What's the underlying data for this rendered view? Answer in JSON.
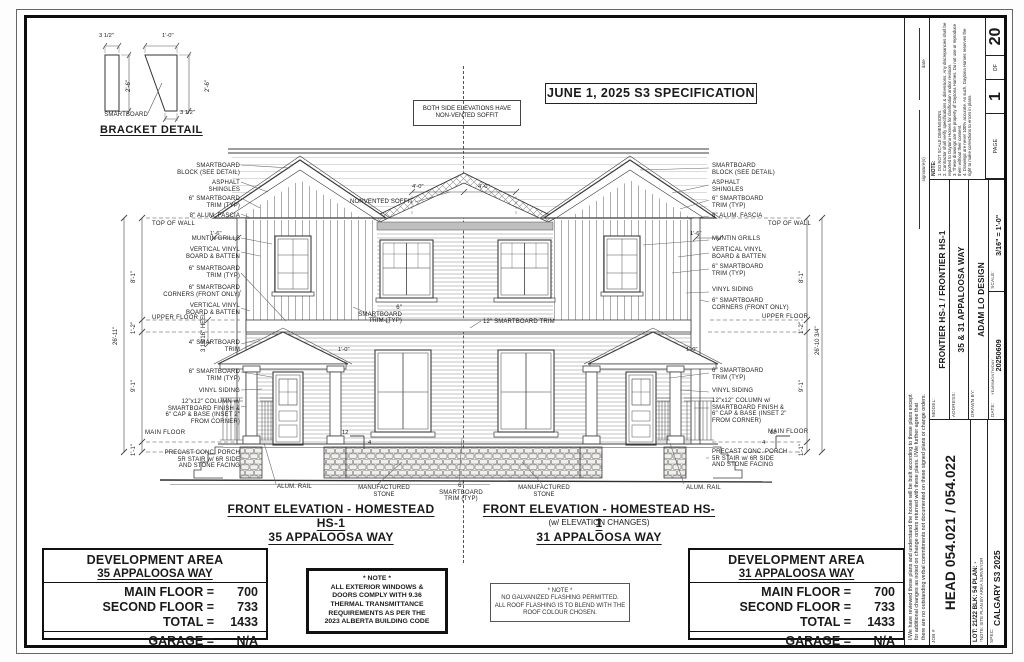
{
  "bracket": {
    "title": "BRACKET DETAIL",
    "material_label": "SMARTBOARD",
    "dim_w1": "3 1/2\"",
    "dim_w2": "1'-0\"",
    "dim_h1": "2'-6\"",
    "dim_h2": "2'-6\"",
    "dim_b2": "3 1/2\""
  },
  "banners": {
    "spec": "JUNE 1, 2025 S3 SPECIFICATION",
    "soffit": "BOTH SIDE ELEVATIONS HAVE\nNON-VENTED SOFFIT"
  },
  "ann": {
    "left": [
      "SMARTBOARD\nBLOCK (SEE DETAIL)",
      "ASPHALT\nSHINGLES",
      "6\" SMARTBOARD\nTRIM (TYP)",
      "8\" ALUM. FASCIA",
      "TOP OF WALL",
      "MUNTIN GRILLS",
      "VERTICAL VINYL\nBOARD & BATTEN",
      "6\" SMARTBOARD\nTRIM (TYP)",
      "6\" SMARTBOARD\nCORNERS (FRONT ONLY)",
      "VERTICAL VINYL\nBOARD & BATTEN",
      "UPPER FLOOR",
      "4\" SMARTBOARD\nTRIM",
      "6\" SMARTBOARD\nTRIM (TYP)",
      "VINYL SIDING",
      "12\"x12\" COLUMN w/\nSMARTBOARD FINISH &\n6\" CAP & BASE (INSET 2\"\nFROM CORNER)",
      "MAIN FLOOR",
      "PRECAST CONC. PORCH\n5R STAIR w/ 6R SIDE\nAND STONE FACING"
    ],
    "right": [
      "SMARTBOARD\nBLOCK (SEE DETAIL)",
      "ASPHALT\nSHINGLES",
      "6\" SMARTBOARD\nTRIM (TYP)",
      "8\" ALUM. FASCIA",
      "TOP OF WALL",
      "MUNTIN GRILLS",
      "VERTICAL VINYL\nBOARD & BATTEN",
      "6\" SMARTBOARD\nTRIM (TYP)",
      "VINYL SIDING",
      "6\" SMARTBOARD\nCORNERS (FRONT ONLY)",
      "UPPER FLOOR",
      "6\" SMARTBOARD\nTRIM (TYP)",
      "VINYL SIDING",
      "12\"x12\" COLUMN w/\nSMARTBOARD FINISH &\n6\" CAP & BASE (INSET 2\"\nFROM CORNER)",
      "MAIN FLOOR",
      "PRECAST CONC. PORCH\n5R STAIR w/ 6R SIDE\nAND STONE FACING"
    ],
    "center": [
      "NONVENTED SOFFIT",
      "6\" SMARTBOARD\nTRIM (TYP)",
      "12\" SMARTBOARD TRIM",
      "ALUM. RAIL",
      "MANUFACTURED\nSTONE",
      "6\" SMARTBOARD\nTRIM (TYP)",
      "MANUFACTURED\nSTONE",
      "ALUM. RAIL"
    ]
  },
  "dims": {
    "left": [
      "8'-1\"",
      "1'-2\"",
      "9'-1\"",
      "1'-1\"",
      "26'-11\""
    ],
    "right": [
      "8'-1\"",
      "1'-2\"",
      "9'-1\"",
      "1'-1\"",
      "26'-10 3/4\""
    ],
    "small": [
      "1'-6\"",
      "4'-0\"",
      "1'-0\"",
      "3 15/16\" HEEL"
    ],
    "pitch": {
      "run": "12",
      "rise": "4"
    }
  },
  "titles": {
    "left": {
      "title": "FRONT ELEVATION - HOMESTEAD HS-1",
      "address": "35 APPALOOSA WAY"
    },
    "right": {
      "title": "FRONT ELEVATION - HOMESTEAD HS-1",
      "subtitle": "(w/ ELEVATION CHANGES)",
      "address": "31 APPALOOSA WAY"
    }
  },
  "dev_areas": [
    {
      "title": "DEVELOPMENT AREA",
      "address": "35 APPALOOSA WAY",
      "rows": [
        {
          "label": "MAIN FLOOR =",
          "value": "700"
        },
        {
          "label": "SECOND FLOOR =",
          "value": "733"
        },
        {
          "label": "TOTAL =",
          "value": "1433"
        }
      ],
      "garage": {
        "label": "GARAGE =",
        "value": "N/A"
      }
    },
    {
      "title": "DEVELOPMENT AREA",
      "address": "31 APPALOOSA WAY",
      "rows": [
        {
          "label": "MAIN FLOOR =",
          "value": "700"
        },
        {
          "label": "SECOND FLOOR =",
          "value": "733"
        },
        {
          "label": "TOTAL =",
          "value": "1433"
        }
      ],
      "garage": {
        "label": "GARAGE =",
        "value": "N/A"
      }
    }
  ],
  "note_boxes": [
    {
      "lines": [
        "* NOTE *",
        "ALL EXTERIOR WINDOWS &",
        "DOORS COMPLY WITH 9.36",
        "THERMAL TRANSMITTANCE",
        "REQUIREMENTS AS PER THE",
        "2023 ALBERTA BUILDING CODE"
      ]
    },
    {
      "lines": [
        "* NOTE *",
        "NO GALVANIZED FLASHING PERMITTED.",
        "ALL ROOF FLASHING IS TO BLEND WITH THE",
        "ROOF COLOUR CHOSEN."
      ]
    }
  ],
  "title_block": {
    "page": {
      "label": "PAGE",
      "num": "1",
      "of_label": "OF",
      "total": "20"
    },
    "notes_title": "NOTE:",
    "notes": [
      "1. DO NOT SCALE DIMENSIONS.",
      "2. Contractor shall verify specifications & dimensions. Any discrepancies shall be reported to Daytona Homes for clarification and/or revision.",
      "3. These drawings are the property of Daytona Homes. Do not use or reproduce them without their consent.",
      "4. Drawings are never 100% accurate. As such, Daytona Homes reserves the right to make corrections to errors in plans."
    ],
    "model": {
      "label": "MODEL:",
      "value": "FRONTIER HS-1 / FRONTIER HS-1"
    },
    "address": {
      "label": "ADDRESS:",
      "value": "35 & 31 APPALOOSA WAY"
    },
    "drawn_by": {
      "label": "DRAWN BY:",
      "value": "ADAM LO DESIGN"
    },
    "date": {
      "label": "DATE:",
      "sub": "YEAR/MONTH/DAY",
      "value": "20250609"
    },
    "scale": {
      "label": "SCALE:",
      "value": "3/16\" = 1'-0\""
    },
    "job": {
      "label": "JOB #",
      "value": "HEAD 054.021 / 054.022"
    },
    "lot": {
      "value": "LOT: 21/22   BLK: 54   PLAN: -",
      "note": "*NOTE: SITE PLAN BY AREA SURVEYOR"
    },
    "spec": {
      "label": "SPEC:",
      "value": "CALGARY S3 2025"
    },
    "disclaimer": [
      "I/We have reviewed these plans and understand the house will be built according to these plans except",
      "for additional changes as noted on change orders returned with these plans. I/We further agree that",
      "there are no outstanding verbal commitments not documented on these signed plans or change orders."
    ],
    "signature_label": "signature(s)",
    "date_label": "date"
  }
}
